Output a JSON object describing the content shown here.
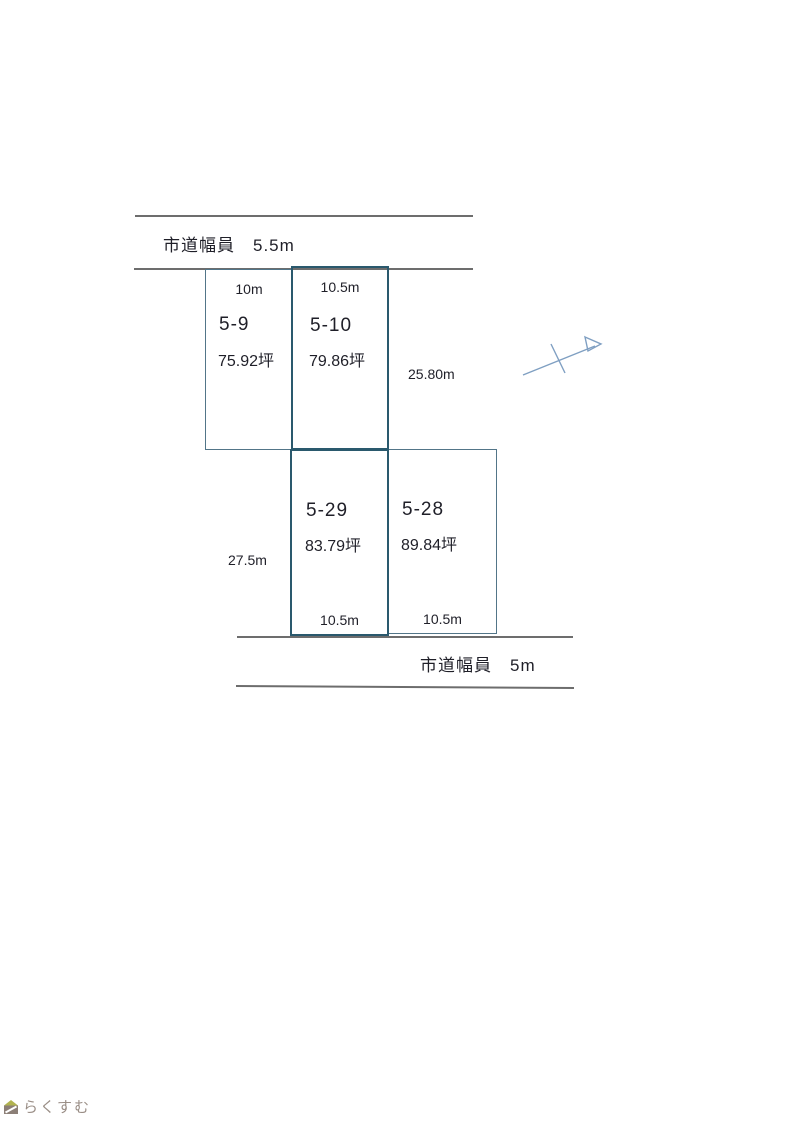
{
  "diagram": {
    "roads": {
      "top": {
        "label": "市道幅員　5.5m"
      },
      "bottom": {
        "label": "市道幅員　5m"
      }
    },
    "plots": [
      {
        "id": "5-9",
        "area": "75.92坪",
        "frontage": "10m"
      },
      {
        "id": "5-10",
        "area": "79.86坪",
        "frontage": "10.5m"
      },
      {
        "id": "5-29",
        "area": "83.79坪",
        "frontage": "10.5m"
      },
      {
        "id": "5-28",
        "area": "89.84坪",
        "frontage": "10.5m"
      }
    ],
    "dimensions": {
      "right_depth": "25.80m",
      "left_depth": "27.5m"
    }
  },
  "logo": {
    "text": "らくすむ"
  },
  "colors": {
    "plot_border_thick": "#2a596d",
    "plot_border_thin": "#527588",
    "road_line": "#6d6d6d",
    "text": "#1f1f28",
    "north_arrow": "#7f9fc2",
    "logo_text": "#9a8e86",
    "logo_roof": "#b2b34f",
    "logo_body": "#8c7f77"
  }
}
